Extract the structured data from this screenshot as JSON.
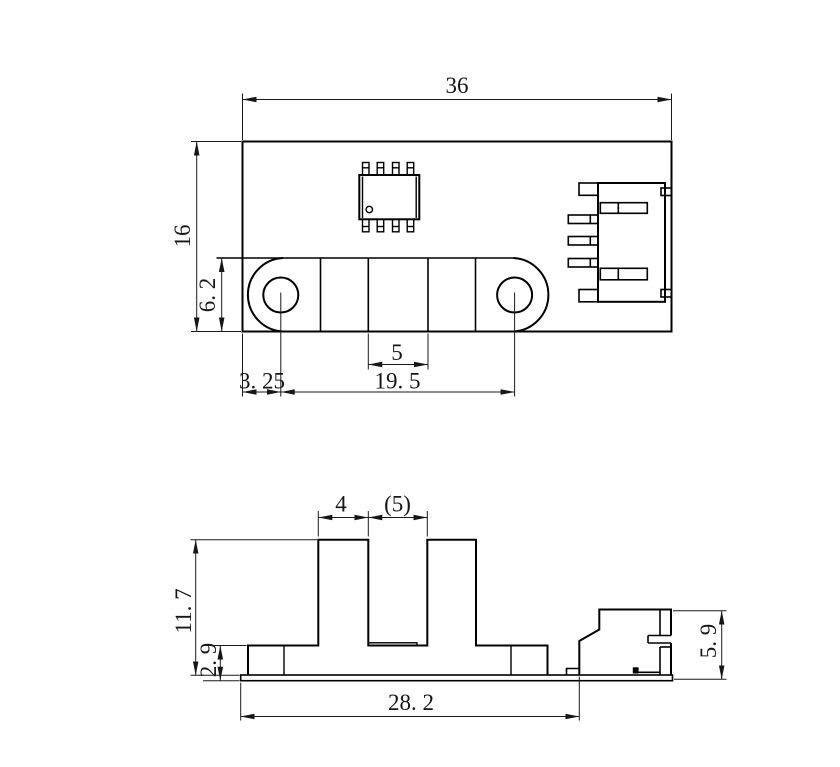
{
  "colors": {
    "line": "#000000",
    "text": "#161616",
    "background": "#ffffff"
  },
  "dimensions": {
    "top": {
      "overall_width": "36",
      "overall_height": "16",
      "slot_band_height": "6. 2",
      "slot_width": "5",
      "hole_edge_offset": "3. 25",
      "hole_spacing": "19. 5"
    },
    "front": {
      "tower_width": "4",
      "slot_gap": "(5)",
      "overall_height": "11. 7",
      "base_height": "2. 9",
      "connector_height": "5. 9",
      "body_width": "28. 2"
    }
  }
}
